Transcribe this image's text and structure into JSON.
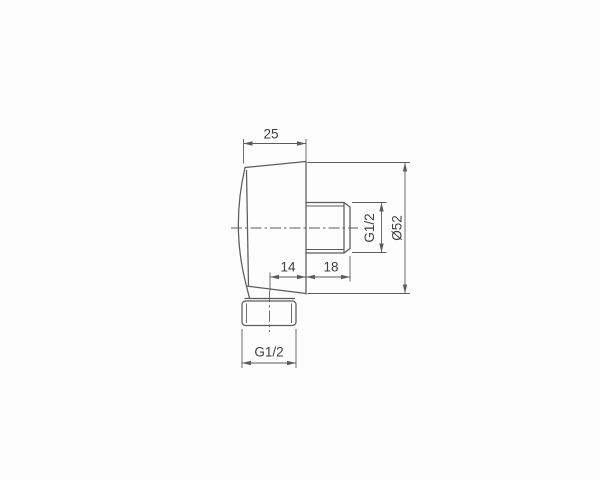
{
  "canvas": {
    "background": "#fdfdfd",
    "line_color": "#5c5c5c",
    "text_color": "#3f3f3f"
  },
  "labels": {
    "top_width": "25",
    "side_thread": "G1/2",
    "diameter": "Ø52",
    "offset": "14",
    "nipple_length": "18",
    "bottom_thread": "G1/2"
  }
}
